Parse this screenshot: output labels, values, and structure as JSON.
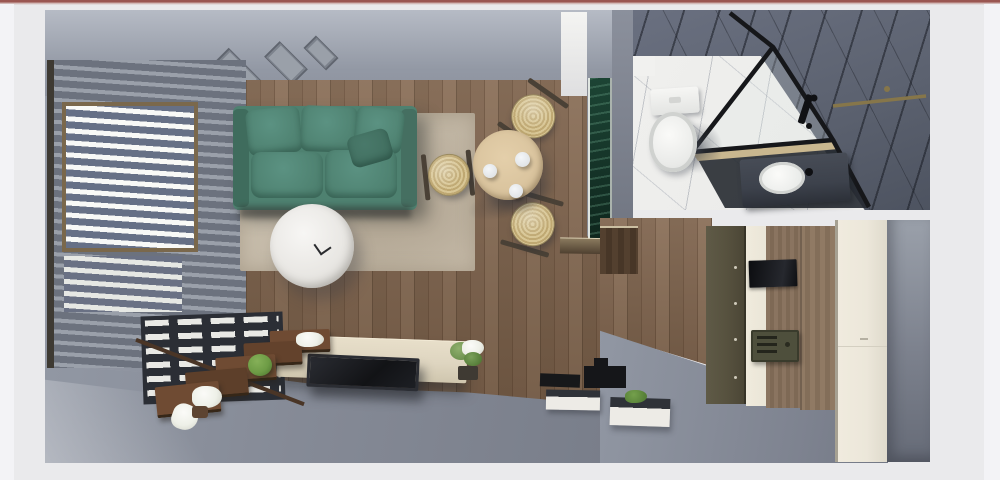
{
  "meta": {
    "view_label": "Top-down 3D floor plan render",
    "renderer": "interior visualization"
  },
  "rooms": {
    "living": "Living room",
    "bathroom": "Bathroom",
    "entry": "Entry hall"
  },
  "objects": {
    "viewport": "3D floor plan viewport",
    "accent_bar": "window accent bar",
    "blinds": "Window wall with horizontal blinds",
    "radiator": "Radiator under window",
    "vents": "Ceiling diffusers",
    "sofa": "Teal three-seat sofa",
    "rug": "Beige area rug",
    "coffee_table": "Round white coffee table",
    "dining_table": "Round wooden dining table",
    "dining_chair": "Wicker dining chair",
    "plates": "Tableware",
    "green_panel": "Green marble accent panel with LED edges",
    "console": "TV sideboard",
    "tv": "Flat TV panel",
    "plant_shelf": "Wooden ladder plant shelf",
    "plant": "Potted plant",
    "flowers": "White flowers",
    "toilet": "Toilet",
    "shower": "Corner shower with black-framed glass",
    "sink": "Countertop washbasin",
    "towel_bar": "Brass towel bar",
    "coat_wall": "Olive entry coat wall with hooks",
    "entry_door": "Wooden entrance door",
    "mirror_panel": "Black wall panel",
    "intercom_box": "Recessed wall box",
    "wardrobe": "Cream wardrobe cabinet",
    "shoe_tray": "Entry tray planter",
    "floor_mat": "Dark floor mat"
  },
  "colors": {
    "bg": "#eaeaec",
    "bg-edge": "#f3f3f6",
    "accent-dark": "#9a5651",
    "accent-light": "#cbaaa7",
    "wall-light": "#b6bbc5",
    "wall-mid": "#8e939f",
    "wall-dark": "#767b87",
    "blind-slat": "#6c727e",
    "blind-gap": "#9aa0aa",
    "blind-bright": "#f8f9f7",
    "frame-dark": "#3e3a33",
    "frame-tan": "#7a684c",
    "radiator-dark": "#2b2e35",
    "radiator-white": "#e9e9e5",
    "wood-a": "#80654f",
    "wood-b": "#6e543f",
    "wood-c": "#8a6f58",
    "wood-d": "#67503c",
    "rug-a": "#cdc3b2",
    "rug-b": "#bdb2a0",
    "sofa": "#4e8170",
    "sofa-dark": "#3f6c5d",
    "sofa-light": "#5b9282",
    "table-top": "#d8c29c",
    "wicker-a": "#d8c695",
    "wicker-b": "#bfa872",
    "chair-frame": "#4a4136",
    "white-obj": "#f2f1ef",
    "green-marble": "#143126",
    "led": "#dfe5e0",
    "bath-floor": "#e9e9e7",
    "bath-marble": "#5c6270",
    "vein-dark": "rgba(24,27,35,0.55)",
    "black": "#17181a",
    "brass": "#86764a",
    "counter": "#3d424c",
    "olive": "#57523f",
    "cream": "#eae5d7",
    "door-wood": "#8a7460",
    "wardrobe": "#ece7da",
    "console": "#ded5c0",
    "tv": "#1b1c20",
    "leaf": "#6d9b45",
    "leaf-dark": "#47702c",
    "flower": "#eef0e8",
    "pot": "#5d4431",
    "shelf-a": "#6f4b33",
    "shelf-b": "#5d3f2a",
    "gray-floor": "#858a96"
  }
}
